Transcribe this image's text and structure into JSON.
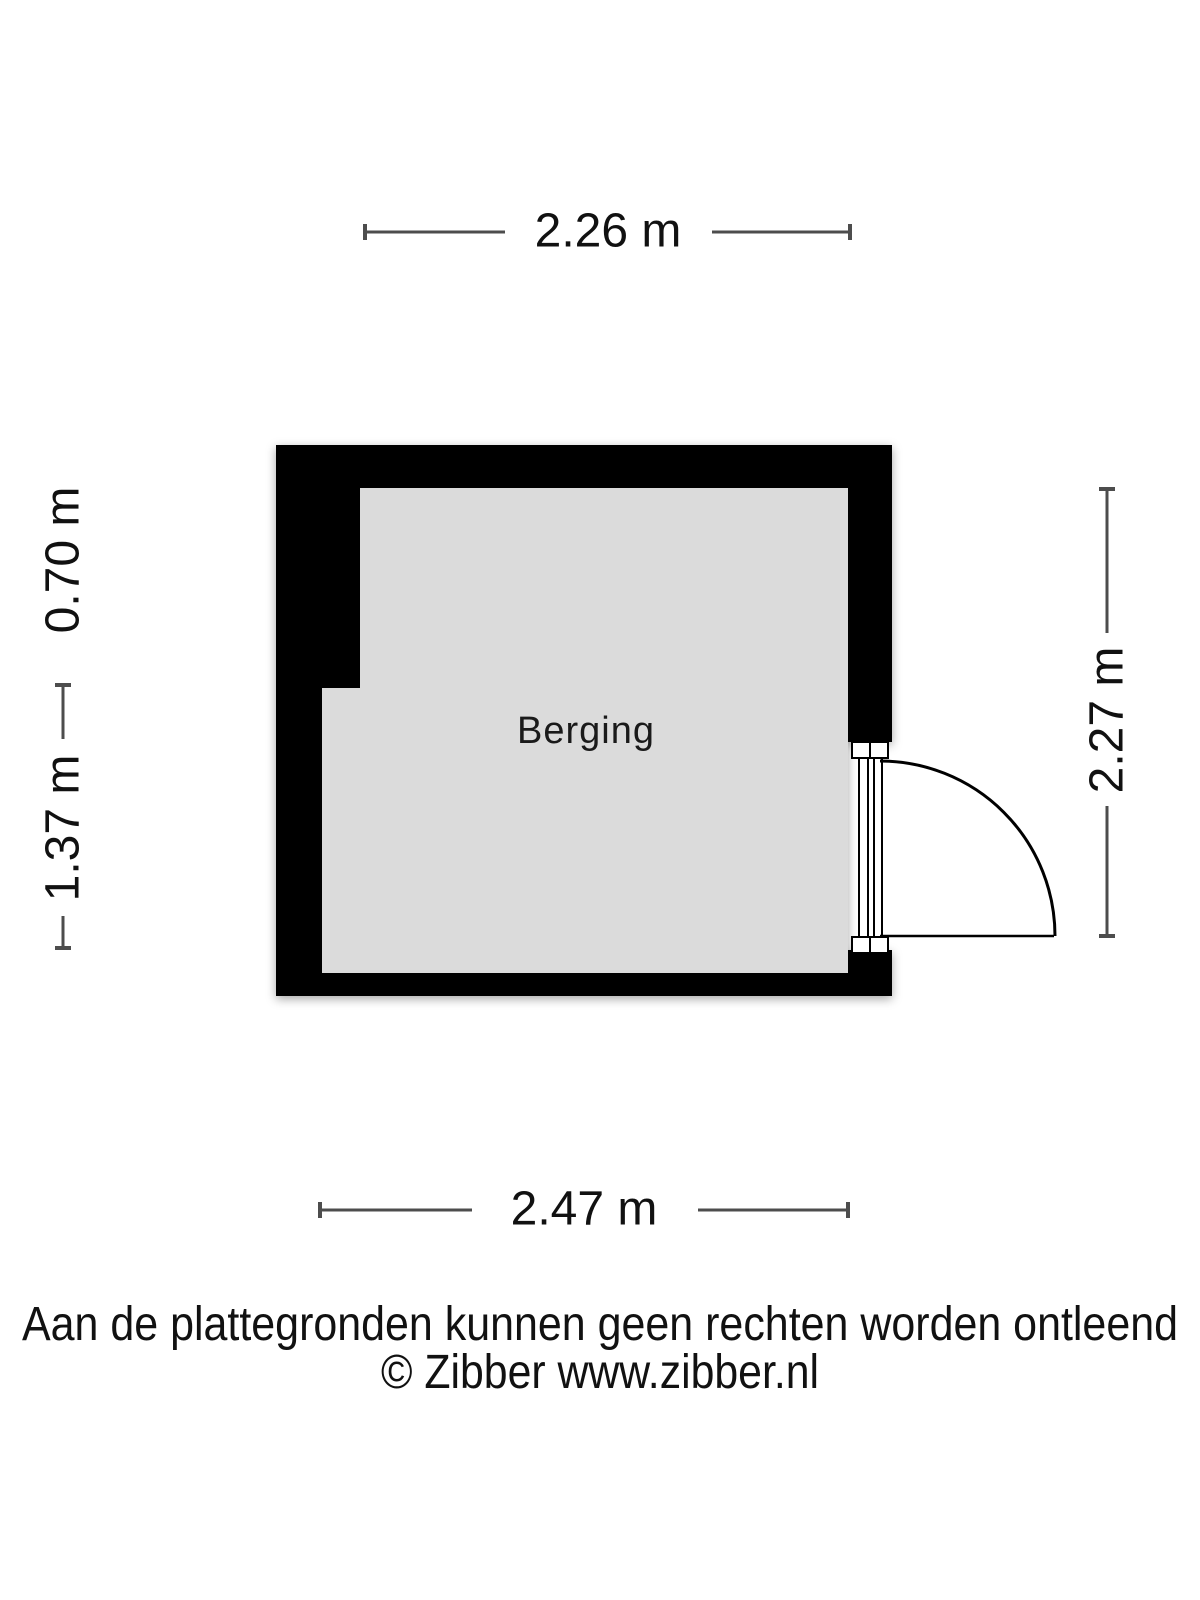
{
  "floor_plan": {
    "room": {
      "label": "Berging"
    },
    "dimensions": {
      "top": "2.26 m",
      "left_upper": "0.70 m",
      "left_lower": "1.37 m",
      "right": "2.27 m",
      "bottom": "2.47 m"
    },
    "colors": {
      "wall": "#000000",
      "floor": "#dbdbdb",
      "dimension_line": "#4d4d4d",
      "text": "#111111",
      "background": "#ffffff"
    }
  },
  "footer": {
    "disclaimer": "Aan de plattegronden kunnen geen rechten worden ontleend",
    "credit": "© Zibber www.zibber.nl"
  }
}
